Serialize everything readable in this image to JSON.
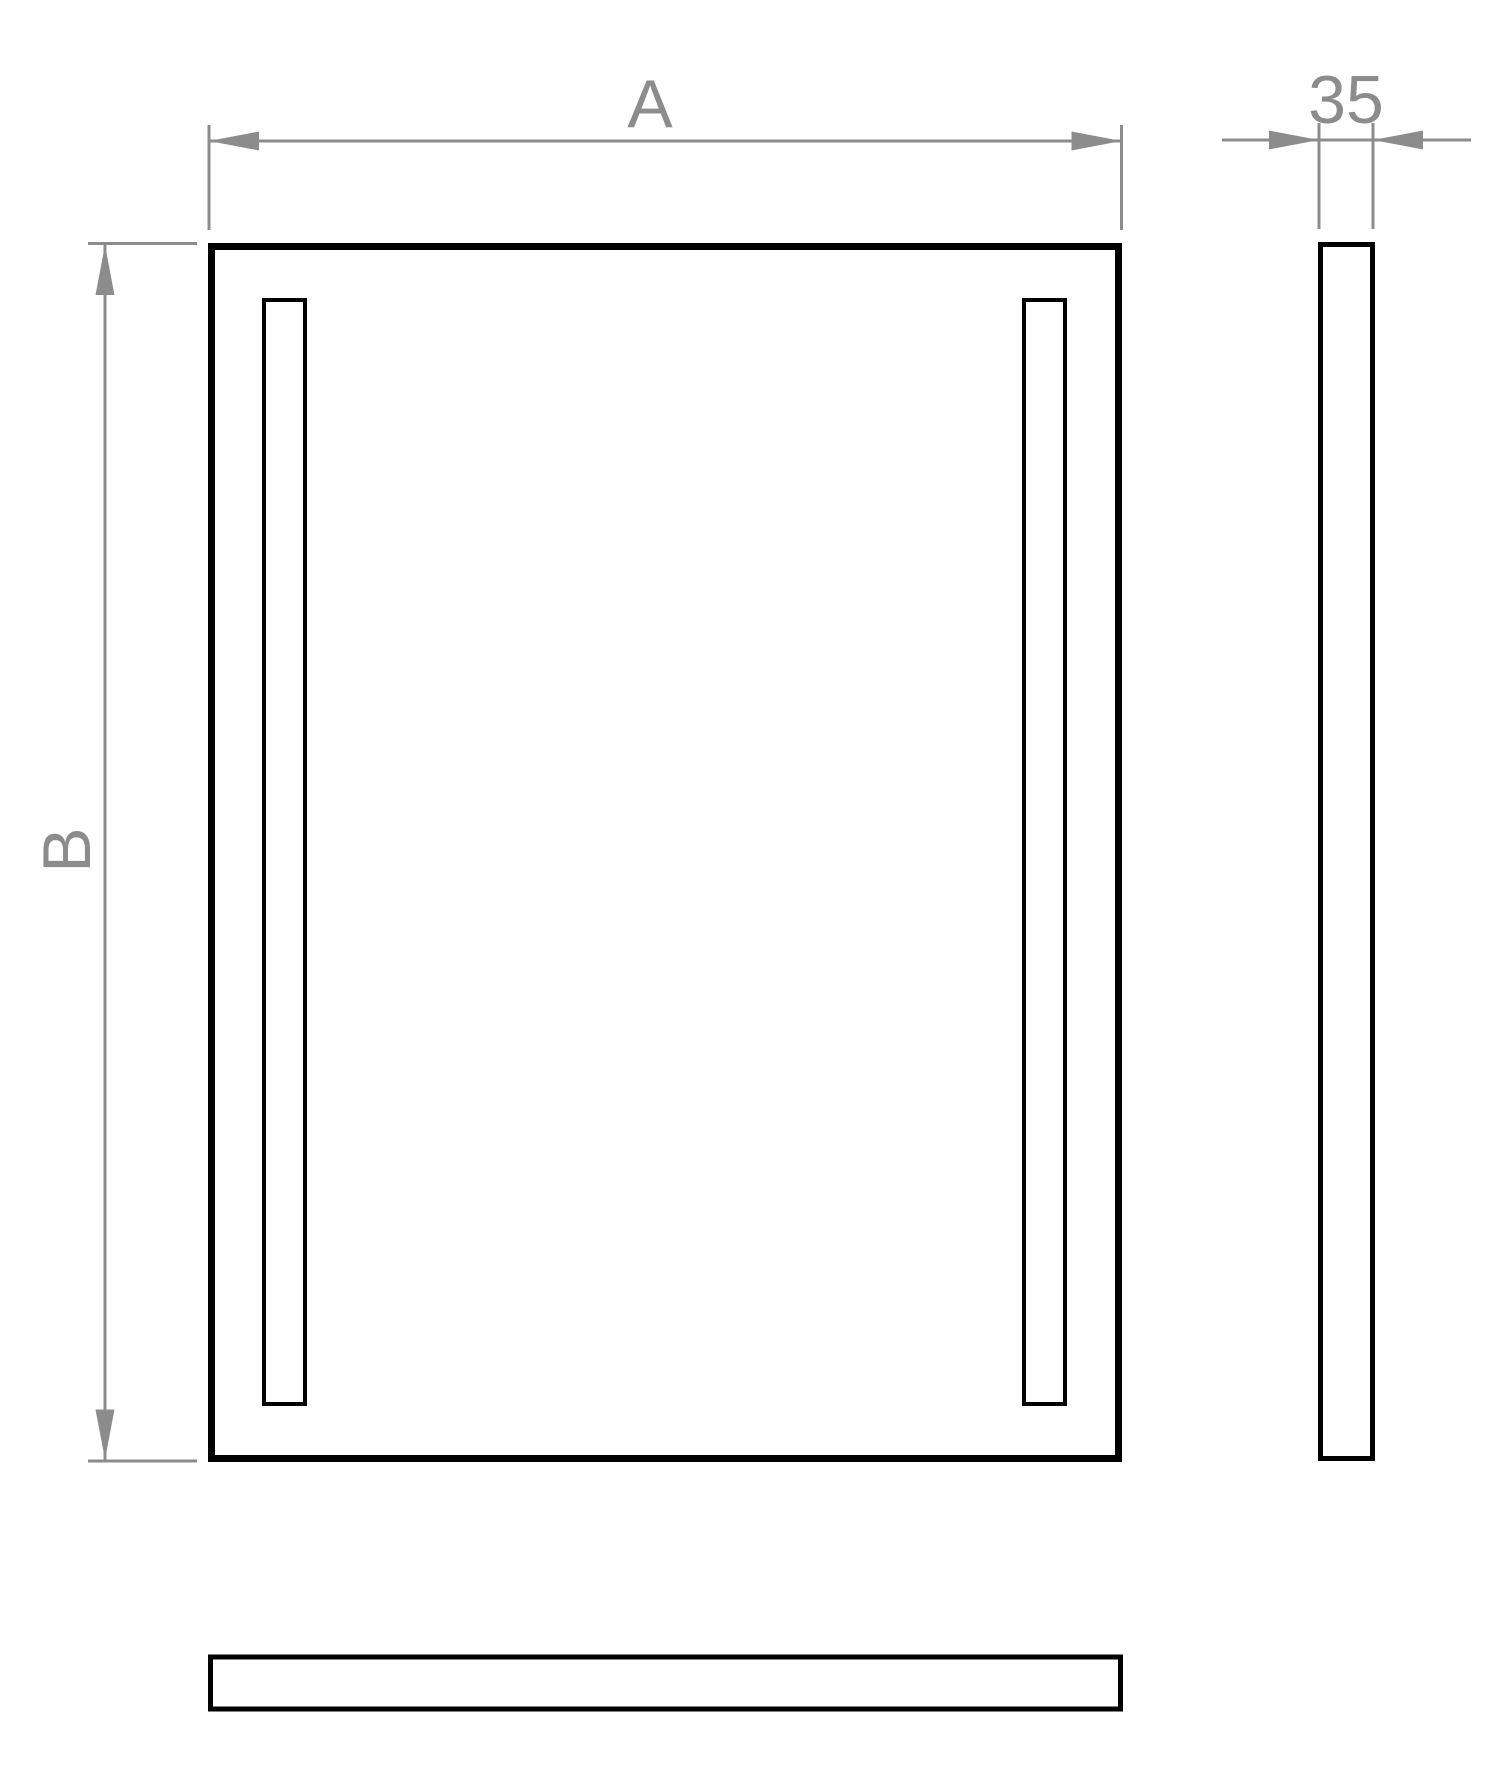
{
  "drawing": {
    "labels": {
      "width": "A",
      "height": "B",
      "depth": "35"
    },
    "colors": {
      "outline": "#000000",
      "dimension": "#8c8c8c",
      "background": "#ffffff"
    }
  }
}
